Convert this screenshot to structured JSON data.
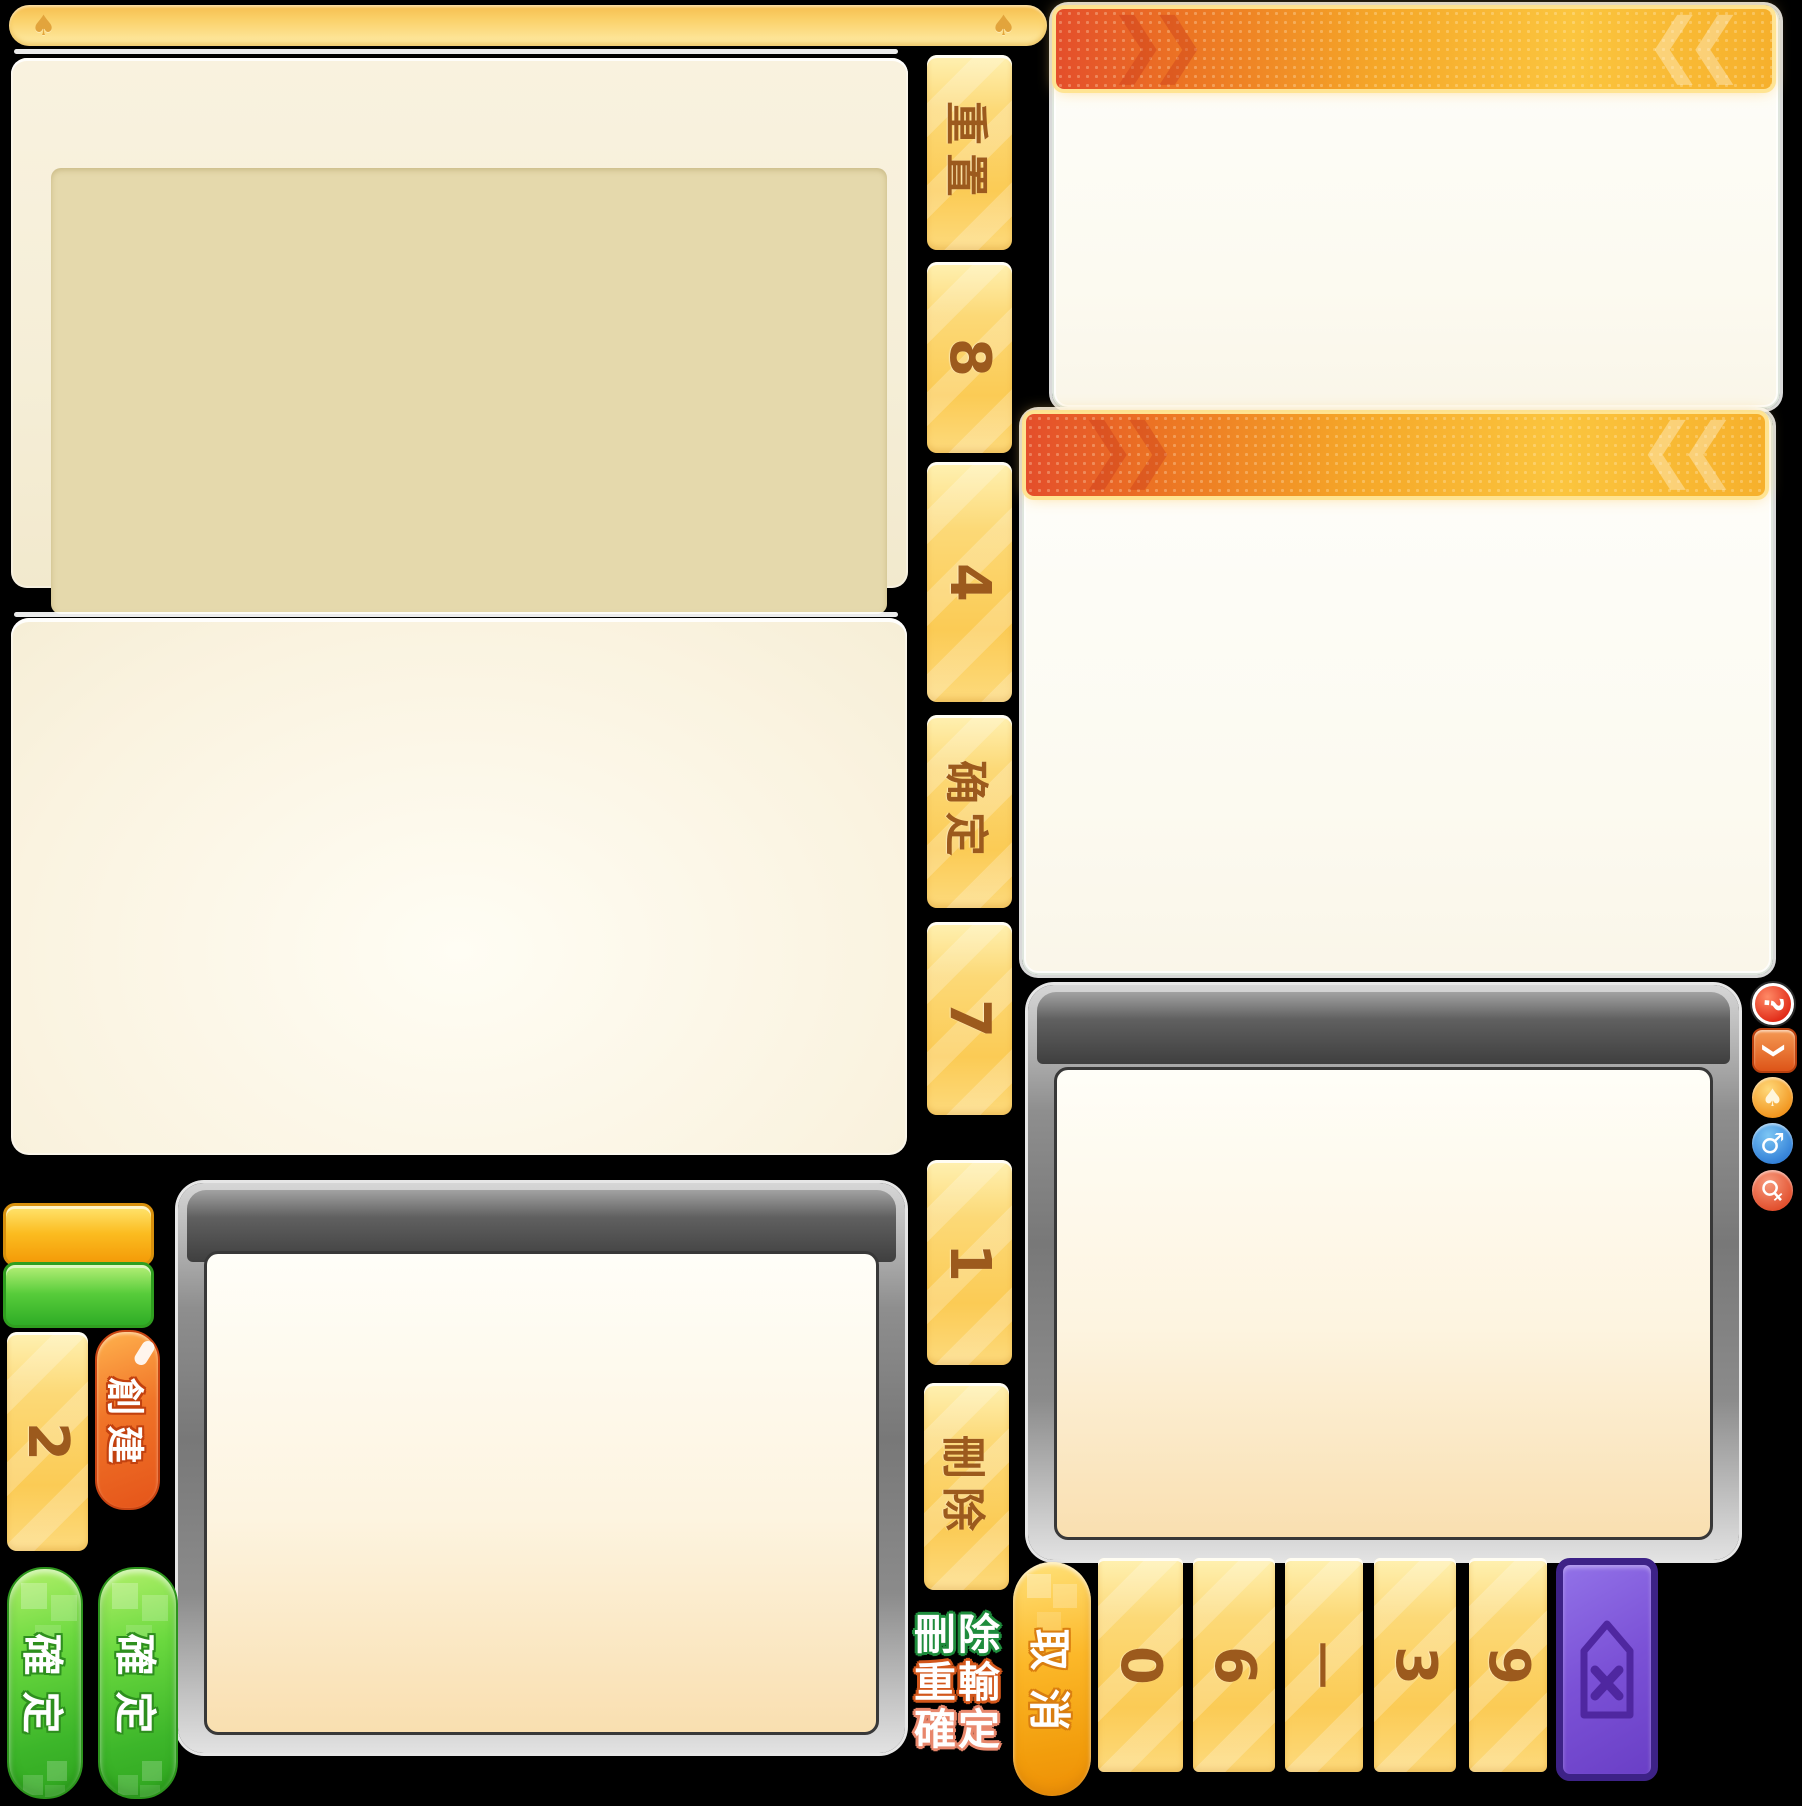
{
  "topbar": {
    "spade_glyph": "♠"
  },
  "strip": {
    "buttons": [
      {
        "id": "reset",
        "label": "重置"
      },
      {
        "id": "key-8",
        "label": "8"
      },
      {
        "id": "key-4",
        "label": "4"
      },
      {
        "id": "confirm",
        "label": "确定"
      },
      {
        "id": "key-7",
        "label": "7"
      },
      {
        "id": "key-1",
        "label": "1"
      },
      {
        "id": "delete",
        "label": "刪除"
      }
    ]
  },
  "side_icons": [
    {
      "name": "help",
      "glyph": "?"
    },
    {
      "name": "chevron-down",
      "glyph": "❯"
    },
    {
      "name": "spade",
      "glyph": "♠"
    },
    {
      "name": "male",
      "glyph": "♂"
    },
    {
      "name": "female",
      "glyph": "♀"
    }
  ],
  "buttons": {
    "create": "創建",
    "key_2": "2",
    "confirm_a": "確定",
    "confirm_b": "確定",
    "cancel": "取消"
  },
  "action_texts": {
    "delete": "刪除",
    "retype": "重輸",
    "confirm": "確定"
  },
  "numpad": {
    "keys": [
      "0",
      "6",
      "一",
      "3",
      "9"
    ]
  },
  "deco": {
    "chevrons_right": "❯❯",
    "chevrons_left": "❮❮"
  },
  "colors": {
    "bar_gold": "#F6BE4E",
    "button_yellow": "#FBCB55",
    "text_brown": "#9C5A1D",
    "header_orange": "#E44E2B",
    "confirm_green": "#3DB62A",
    "create_orange": "#E5551A",
    "cancel_gold": "#F29D0C",
    "backspace_purple": "#7B51D6",
    "panel_tan": "#E5D9AC",
    "panel_cream": "#FAF3E0"
  }
}
